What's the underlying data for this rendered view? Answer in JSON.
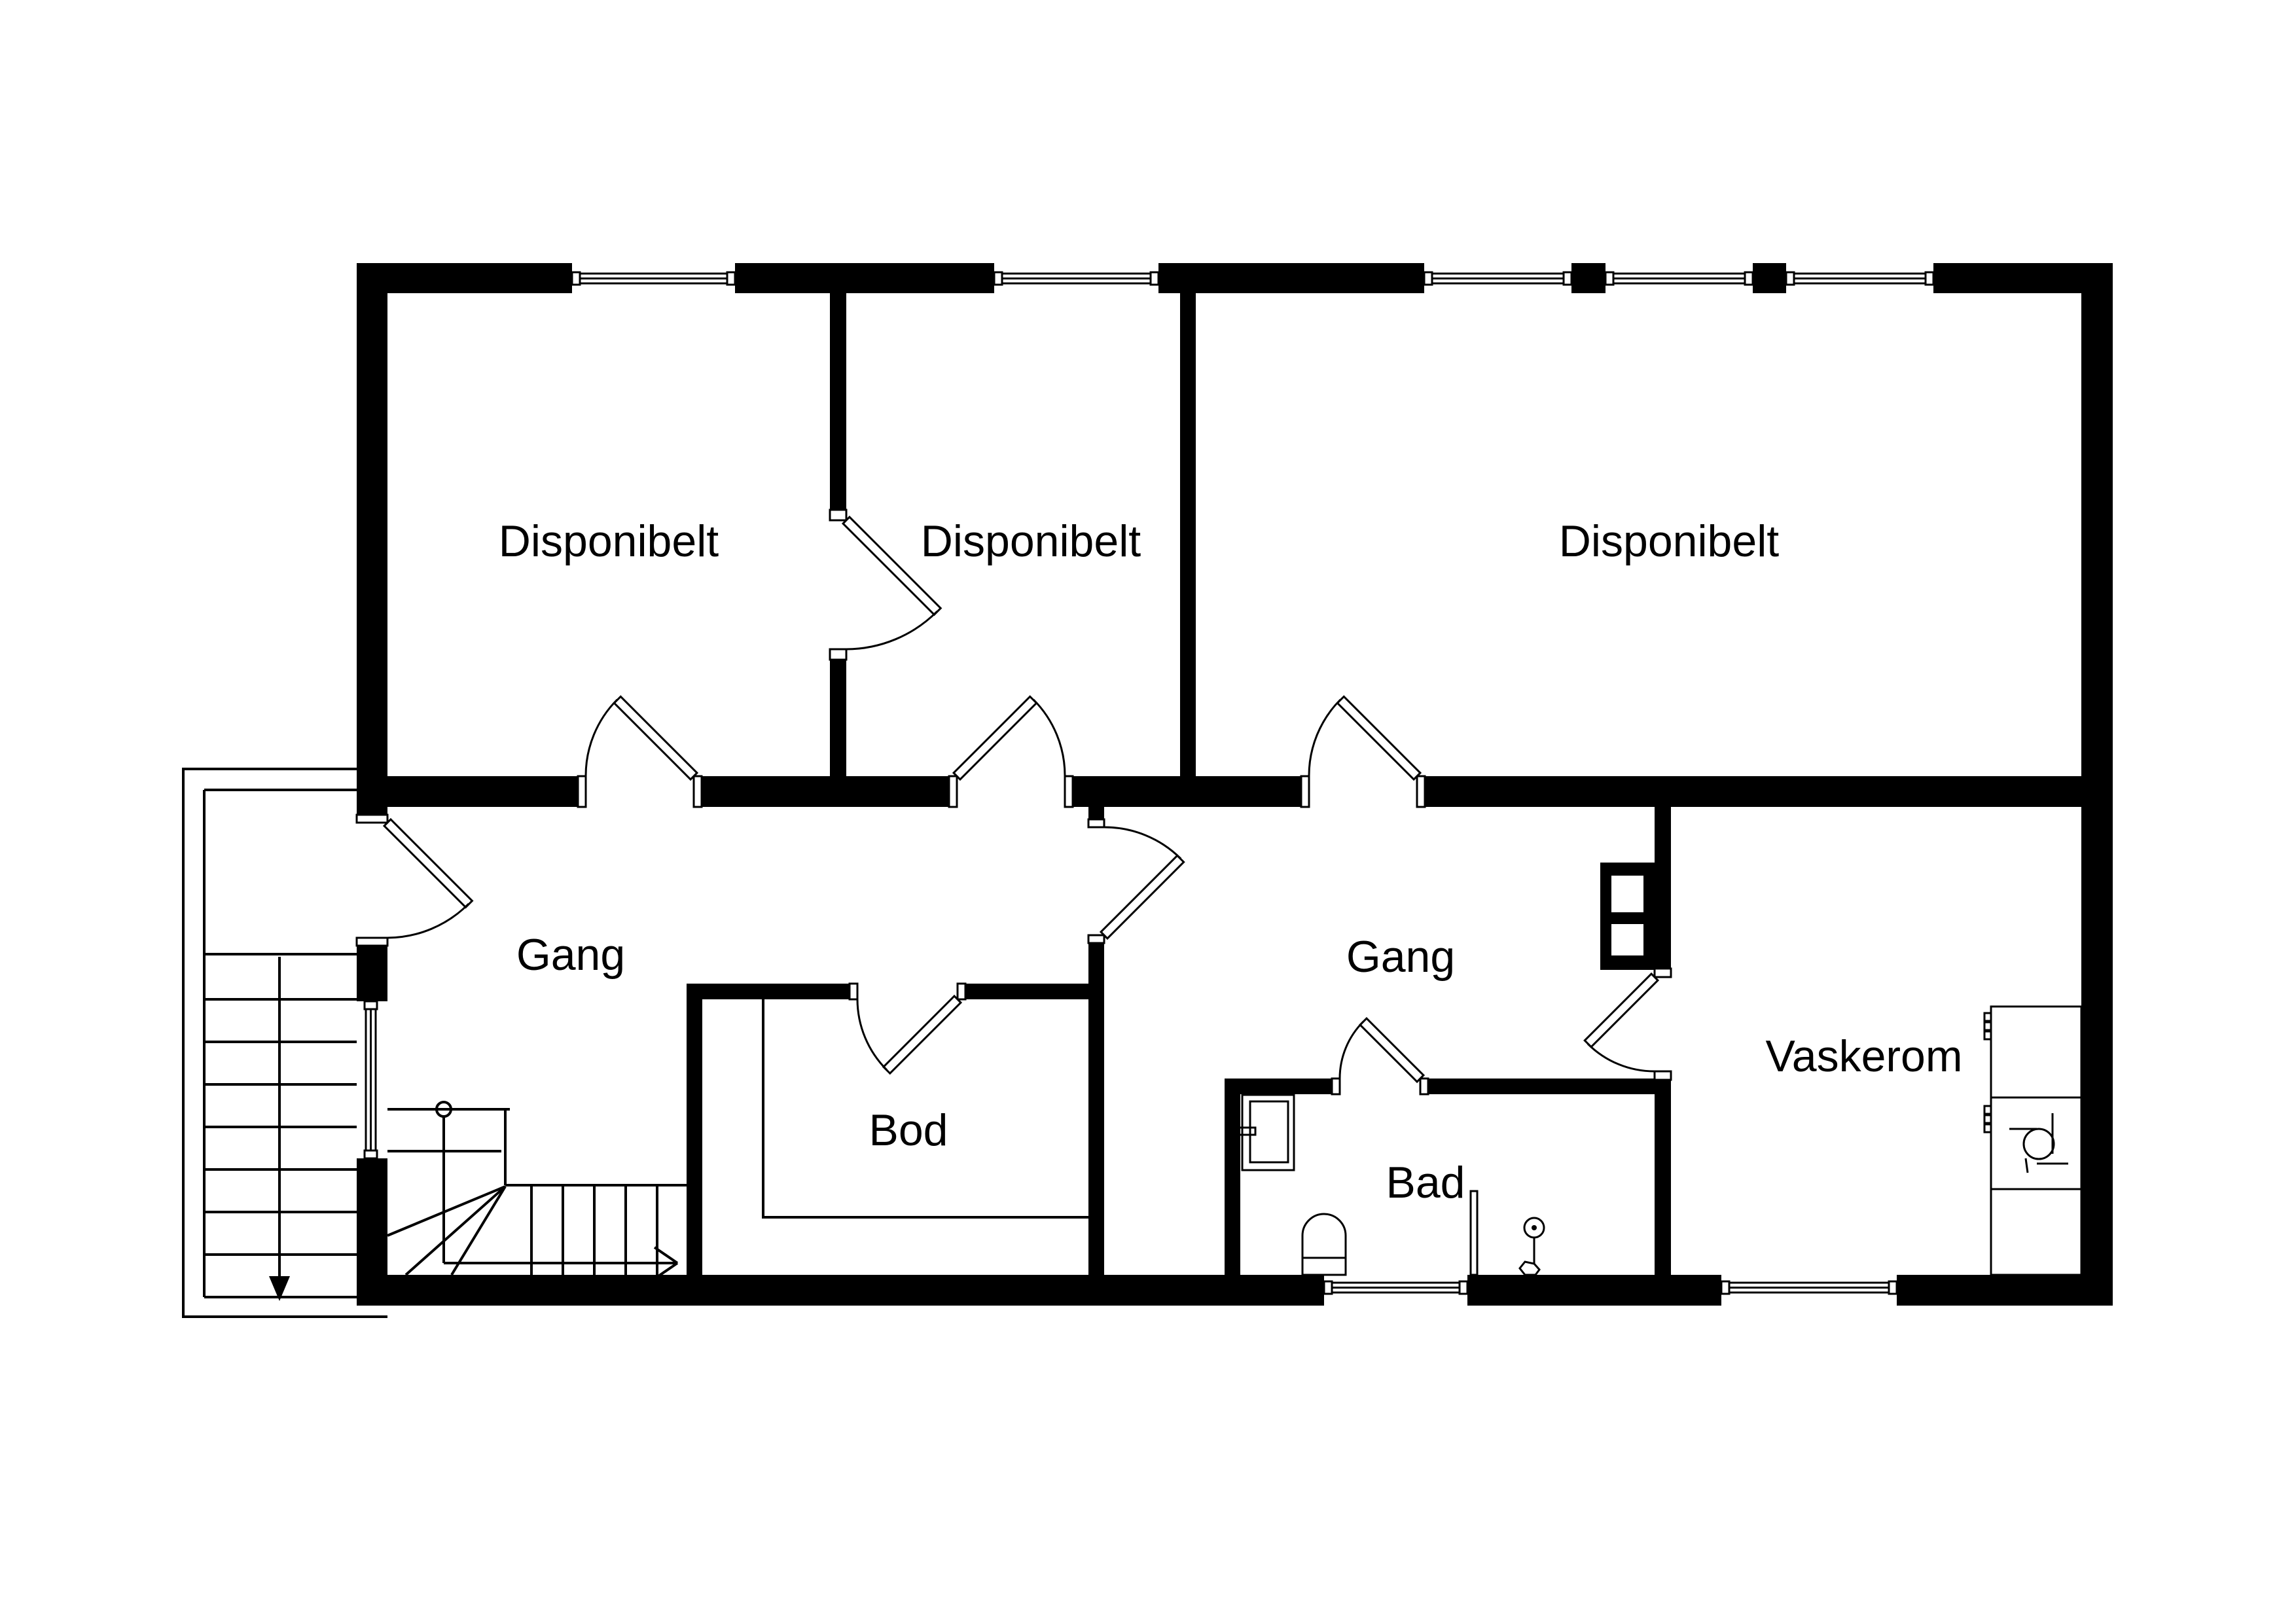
{
  "colors": {
    "wall": "#000000",
    "background": "#ffffff"
  },
  "rooms": [
    {
      "id": "disponibelt-1",
      "label": "Disponibelt"
    },
    {
      "id": "disponibelt-2",
      "label": "Disponibelt"
    },
    {
      "id": "disponibelt-3",
      "label": "Disponibelt"
    },
    {
      "id": "gang-left",
      "label": "Gang"
    },
    {
      "id": "gang-right",
      "label": "Gang"
    },
    {
      "id": "bod",
      "label": "Bod"
    },
    {
      "id": "bad",
      "label": "Bad"
    },
    {
      "id": "vaskerom",
      "label": "Vaskerom"
    }
  ],
  "fixtures": [
    "bathroom-sink",
    "toilet",
    "shower-partition",
    "hand-shower",
    "laundry-counter",
    "laundry-sink",
    "chimney-flue",
    "internal-stairs",
    "external-stairs"
  ],
  "windows_count": 8,
  "doors_count": 9
}
